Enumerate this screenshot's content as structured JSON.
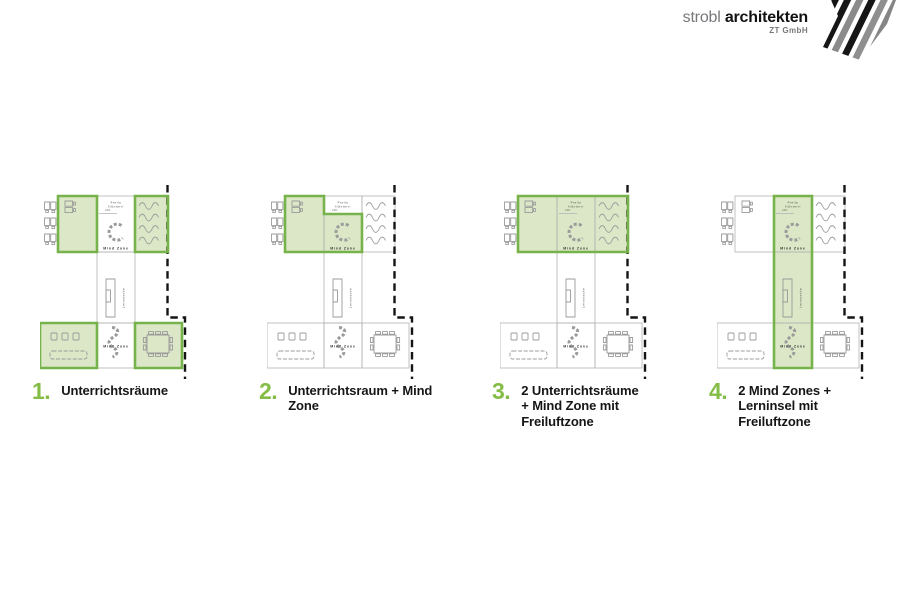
{
  "logo": {
    "name_light": "strobl",
    "name_bold": "architekten",
    "subtitle": "ZT GmbH",
    "mark_icon": "diagonal-stripes"
  },
  "colors": {
    "highlight_border": "#76b44b",
    "highlight_fill": "#dbe7c6",
    "number_green": "#84bd46",
    "room_outline": "#b2b2b2",
    "furniture": "#9b9b9b",
    "boundary_dash": "#141414",
    "label_text": "#3a3a3a",
    "logo_gray": "#77787b",
    "logo_black": "#121212"
  },
  "plan_labels": {
    "freiluft_lines": [
      "Freilu",
      "ftUnterri",
      "cht"
    ],
    "mind_zone_top": "Mind Zone",
    "mind_zone_bottom": "Mind Zone",
    "lernnische": "Lernnische"
  },
  "diagrams": [
    {
      "number": "1.",
      "caption_lines": [
        "Unterrichtsräume"
      ],
      "highlight": "four-classrooms"
    },
    {
      "number": "2.",
      "caption_lines": [
        "Unterrichtsraum + Mind",
        "Zone"
      ],
      "highlight": "classroom-plus-mindzone"
    },
    {
      "number": "3.",
      "caption_lines": [
        "2 Unterrichtsräume",
        "+ Mind Zone mit",
        "Freiluftzone"
      ],
      "highlight": "top-row"
    },
    {
      "number": "4.",
      "caption_lines": [
        "2 Mind Zones +",
        "Lerninsel mit",
        "Freiluftzone"
      ],
      "highlight": "middle-strip"
    }
  ]
}
